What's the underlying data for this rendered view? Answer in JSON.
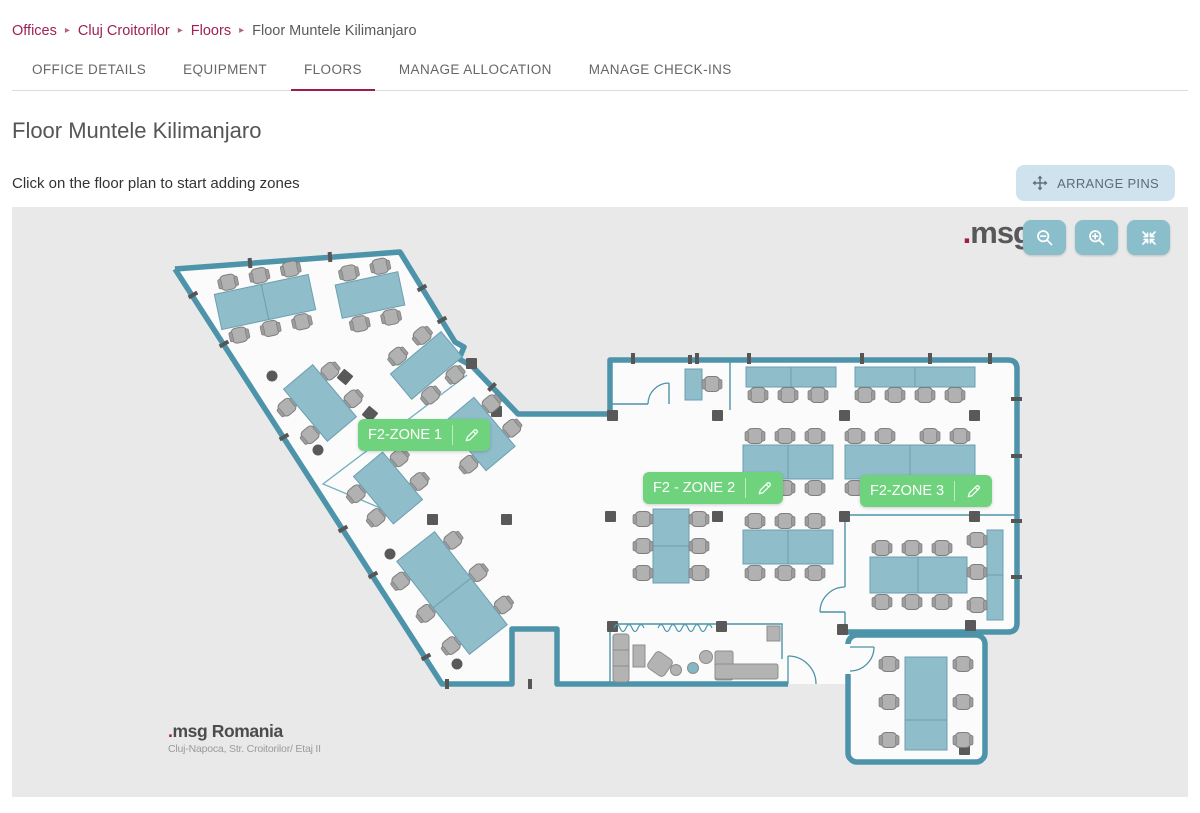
{
  "breadcrumb": {
    "separator": "▸",
    "items": [
      {
        "label": "Offices"
      },
      {
        "label": "Cluj Croitorilor"
      },
      {
        "label": "Floors"
      },
      {
        "label": "Floor Muntele Kilimanjaro"
      }
    ]
  },
  "tabs": [
    {
      "label": "OFFICE DETAILS"
    },
    {
      "label": "EQUIPMENT"
    },
    {
      "label": "FLOORS"
    },
    {
      "label": "MANAGE ALLOCATION"
    },
    {
      "label": "MANAGE CHECK-INS"
    }
  ],
  "page": {
    "title": "Floor Muntele Kilimanjaro",
    "instruction": "Click on the floor plan to start adding zones"
  },
  "toolbar": {
    "arrange_pins_label": "ARRANGE PINS"
  },
  "map": {
    "logo": {
      "dot": ".",
      "text": "msg"
    },
    "controls": [
      {
        "icon": "zoom-out-icon"
      },
      {
        "icon": "zoom-in-icon"
      },
      {
        "icon": "compress-icon"
      }
    ],
    "zones": [
      {
        "label": "F2-ZONE 1"
      },
      {
        "label": "F2 - ZONE 2"
      },
      {
        "label": "F2-ZONE 3"
      }
    ],
    "watermark": {
      "dot": ".",
      "name": "msg Romania",
      "address": "Cluj-Napoca, Str. Croitorilor/ Etaj II"
    }
  },
  "colors": {
    "brand": "#9e1b4f",
    "wall": "#4d93aa",
    "desk": "#8fbdca",
    "zone_green": "#6fd37d",
    "control_teal": "#8abecb",
    "arrange_bg": "#cfe3ee"
  }
}
